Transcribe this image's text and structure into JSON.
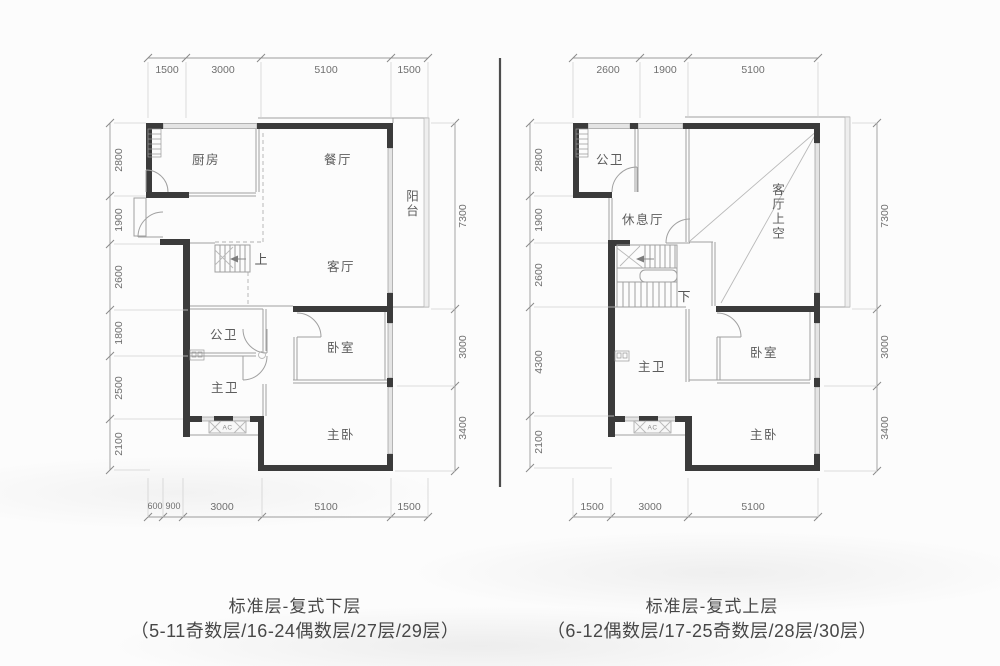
{
  "left_plan": {
    "rooms": {
      "kitchen": "厨房",
      "dining": "餐厅",
      "balcony": "阳台",
      "living": "客厅",
      "public_bath": "公卫",
      "master_bath": "主卫",
      "bedroom": "卧室",
      "master_bedroom": "主卧"
    },
    "stair_direction": "上",
    "ac": "AC",
    "dims": {
      "top": [
        "1500",
        "3000",
        "5100",
        "1500"
      ],
      "bottom": [
        "600",
        "900",
        "3000",
        "5100",
        "1500"
      ],
      "left": [
        "2800",
        "1900",
        "2600",
        "1800",
        "2500",
        "2100"
      ],
      "right": [
        "7300",
        "3000",
        "3400"
      ]
    },
    "caption": {
      "title": "标准层-复式下层",
      "floors": "（5-11奇数层/16-24偶数层/27层/29层）"
    }
  },
  "right_plan": {
    "rooms": {
      "public_bath": "公卫",
      "lounge": "休息厅",
      "living_void": "客厅上空",
      "master_bath": "主卫",
      "bedroom": "卧室",
      "master_bedroom": "主卧"
    },
    "stair_direction": "下",
    "ac": "AC",
    "dims": {
      "top": [
        "2600",
        "1900",
        "5100"
      ],
      "bottom": [
        "1500",
        "3000",
        "5100"
      ],
      "left": [
        "2800",
        "1900",
        "2600",
        "4300",
        "2100"
      ],
      "right": [
        "7300",
        "3000",
        "3400"
      ]
    },
    "caption": {
      "title": "标准层-复式上层",
      "floors": "（6-12偶数层/17-25奇数层/28层/30层）"
    }
  }
}
